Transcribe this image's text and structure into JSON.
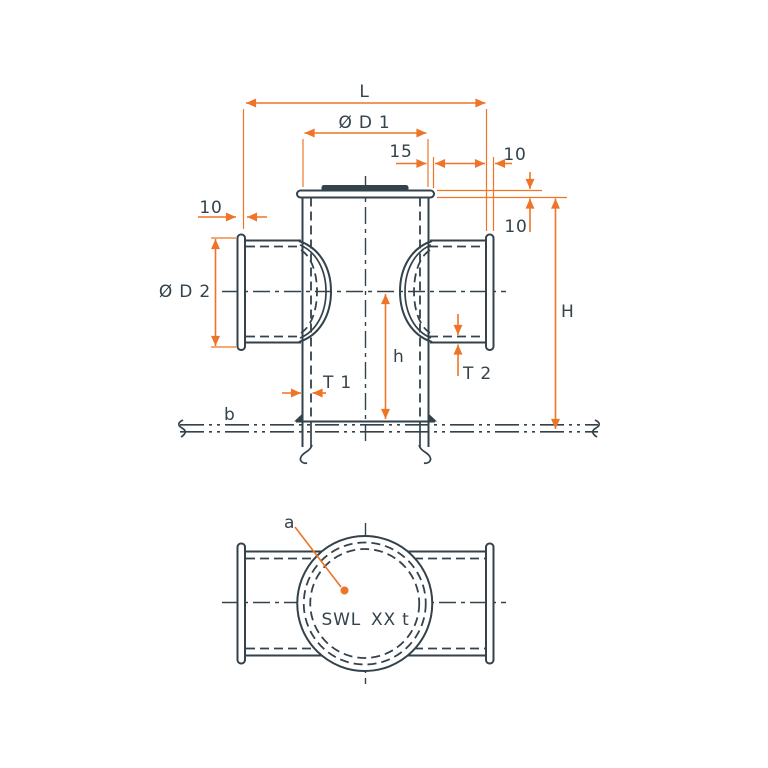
{
  "colors": {
    "ink": "#33424b",
    "accent": "#ee7428",
    "background": "#ffffff"
  },
  "drawing_title": "Cross bollard dimensional drawing",
  "front_view": {
    "length_label": "L",
    "post_diameter_label": "Ø D 1",
    "cap_overhang_label": "15",
    "arm_flange_thickness_right_label": "10",
    "arm_flange_thickness_left_label": "10",
    "top_flange_thickness_label": "10",
    "arm_diameter_label": "Ø D 2",
    "overall_height_label": "H",
    "post_height_label": "h",
    "post_wall_thickness_label": "T 1",
    "arm_wall_thickness_label": "T 2",
    "deck_line_label": "b"
  },
  "plan_view": {
    "center_mark_label": "a",
    "swl_label": "SWL",
    "swl_value": "XX t"
  }
}
